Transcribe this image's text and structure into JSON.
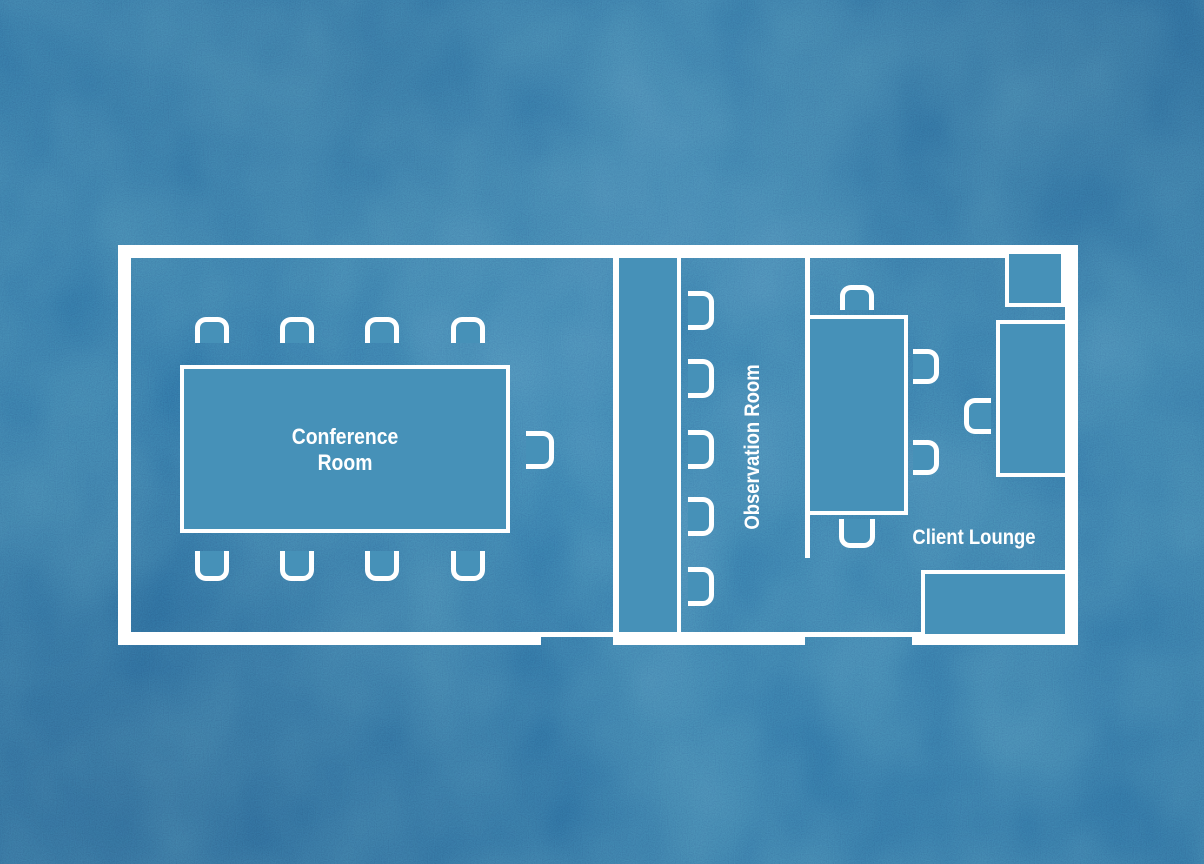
{
  "colors": {
    "background": "#2e72a4",
    "furniture_fill": "#4691b8",
    "wall": "#ffffff",
    "label_text": "#ffffff"
  },
  "rooms": {
    "conference": {
      "label_lines": [
        "Conference",
        "Room"
      ],
      "furniture": {
        "tables": 1,
        "chairs": 9
      }
    },
    "observation": {
      "label": "Observation Room",
      "furniture": {
        "counters": 1,
        "chairs": 5
      }
    },
    "lounge": {
      "label": "Client Lounge",
      "furniture": {
        "tables": 1,
        "chairs": 5,
        "sofas": 1,
        "side_tables": 1,
        "credenzas": 1
      }
    }
  }
}
